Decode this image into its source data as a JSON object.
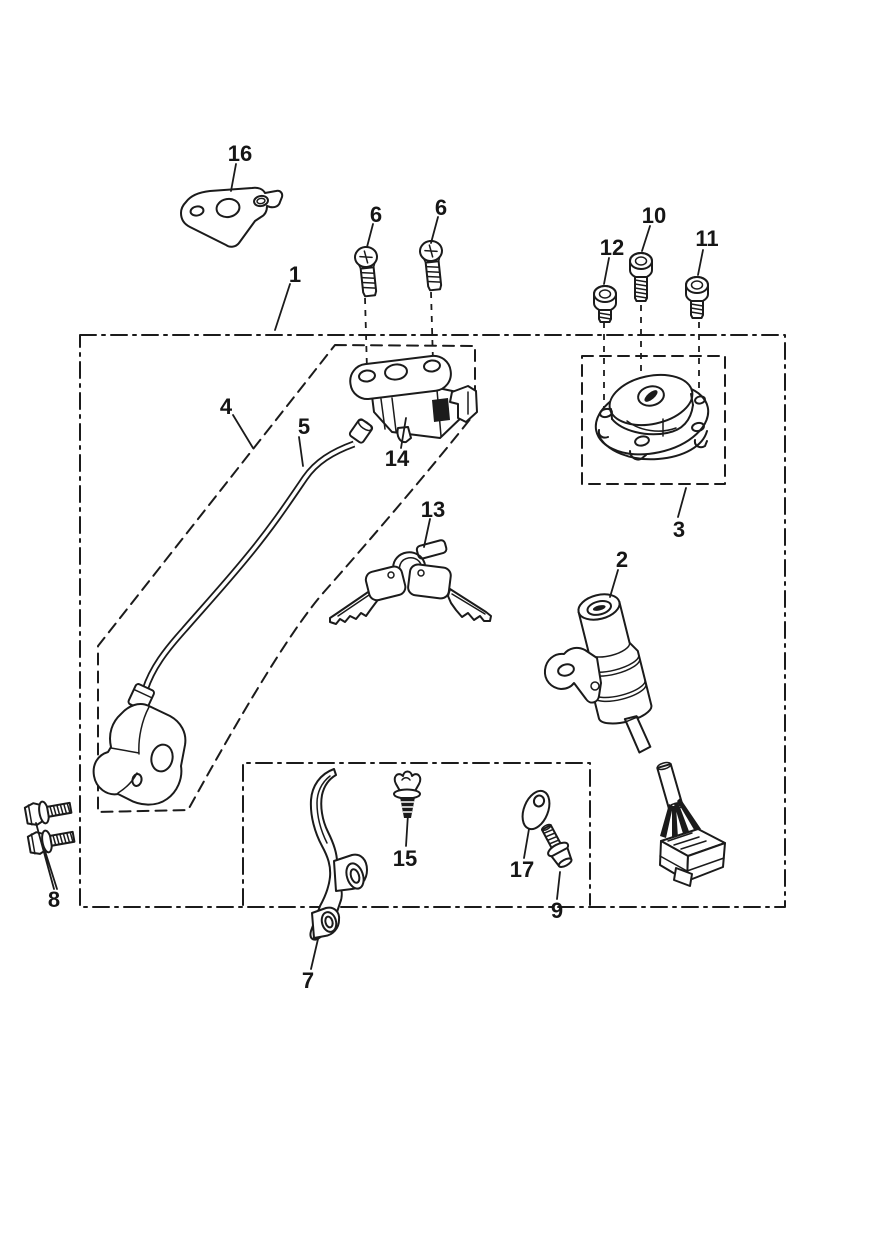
{
  "diagram": {
    "colors": {
      "background": "#ffffff",
      "line": "#1b1b1b",
      "text": "#161616"
    },
    "callouts": {
      "c1": {
        "label": "1"
      },
      "c2": {
        "label": "2"
      },
      "c3": {
        "label": "3"
      },
      "c4": {
        "label": "4"
      },
      "c5": {
        "label": "5"
      },
      "c6a": {
        "label": "6"
      },
      "c6b": {
        "label": "6"
      },
      "c7": {
        "label": "7"
      },
      "c8": {
        "label": "8"
      },
      "c9": {
        "label": "9"
      },
      "c10": {
        "label": "10"
      },
      "c11": {
        "label": "11"
      },
      "c12": {
        "label": "12"
      },
      "c13": {
        "label": "13"
      },
      "c14": {
        "label": "14"
      },
      "c15": {
        "label": "15"
      },
      "c16": {
        "label": "16"
      },
      "c17": {
        "label": "17"
      }
    }
  }
}
